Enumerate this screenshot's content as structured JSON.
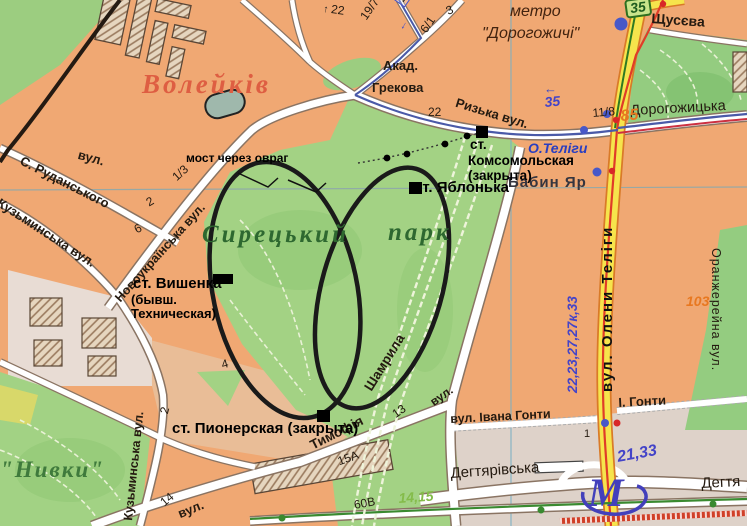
{
  "map": {
    "district_labels": {
      "voleikiv": "Волейків",
      "syretskyi": "Сирецький",
      "park_word": "парк",
      "nyvky": "\"Нивки\"",
      "babyn_yar": "Бабин Яр"
    },
    "metro": {
      "line1": "метро",
      "line2": "\"Дорогожичі\"",
      "station_telihy": "О.Теліги",
      "m_symbol": "М"
    },
    "streets": {
      "shchusieva": "Щусєва",
      "akad": "Акад.",
      "hrekova": "Грекова",
      "ryzka": "Ризька вул.",
      "dorohozhytska": "Дорогожицька",
      "olena_telihy": "вул. Олени Теліги",
      "oranzhereina": "Оранжерейна вул.",
      "rud_vul": "вул.",
      "rudanskoho": "С. Руданського",
      "novoukrainska": "Новоукраїнська вул.",
      "kuzminska_upper": "Кузьминська вул.",
      "kuzminska_lower": "Кузьминська вул.",
      "tymofiia": "Тимофія",
      "shamryla": "Шамрила",
      "shamryla_vul": "вул.",
      "ivana_honty": "вул. Івана Гонти",
      "i_honty": "І. Гонти",
      "dehtiarivska": "Дегтярівська",
      "dehtiarivska_right": "Дегтя",
      "vul_bottom": "вул."
    },
    "stations": {
      "vyshenka": "ст. Вишенка",
      "vyshenka_note1": "(бывш.",
      "vyshenka_note2": "Техническая)",
      "yablonka": "ст. Яблонька",
      "komsomolska_st": "ст.",
      "komsomolska_name": "Комсомольская",
      "komsomolska_note": "(закрыта)",
      "pionerska": "ст. Пионерская (закрыта)"
    },
    "annotation_bridge": "мост через овраг",
    "routes": {
      "shield_35": "35",
      "blue_35": "35",
      "arrow_left": "←",
      "arrow_up": "↑",
      "arrow_down": "↓",
      "box_16": "16",
      "tram_list_vertical": "22,23,27,27к,33",
      "tram_21_33": "21,33",
      "green_14_15": "14,15"
    },
    "numbers": {
      "n22_top": "22",
      "n19_7": "19/7",
      "n3": "3",
      "n6_1": "6/1",
      "n22_park": "22",
      "n1_3": "1/3",
      "n2": "2",
      "n6": "6",
      "n11_8": "11/8",
      "n85": "85",
      "n103": "103",
      "n4": "4",
      "n2_b": "2",
      "n13": "13",
      "n15a": "15А",
      "n60v": "60В",
      "n14": "14",
      "n1": "1"
    },
    "colors": {
      "background_orange": "#f0a873",
      "park_green": "#a3d284",
      "road_yellow": "#f6e44c",
      "route_blue": "#4a5aa8",
      "route_red": "#d8402c",
      "rail_black": "#1a1a1a",
      "district_label_orange": "#de5e42",
      "number_orange": "#e87820",
      "number_green": "#84bc4a",
      "grid_teal": "#7ab0c4"
    }
  }
}
